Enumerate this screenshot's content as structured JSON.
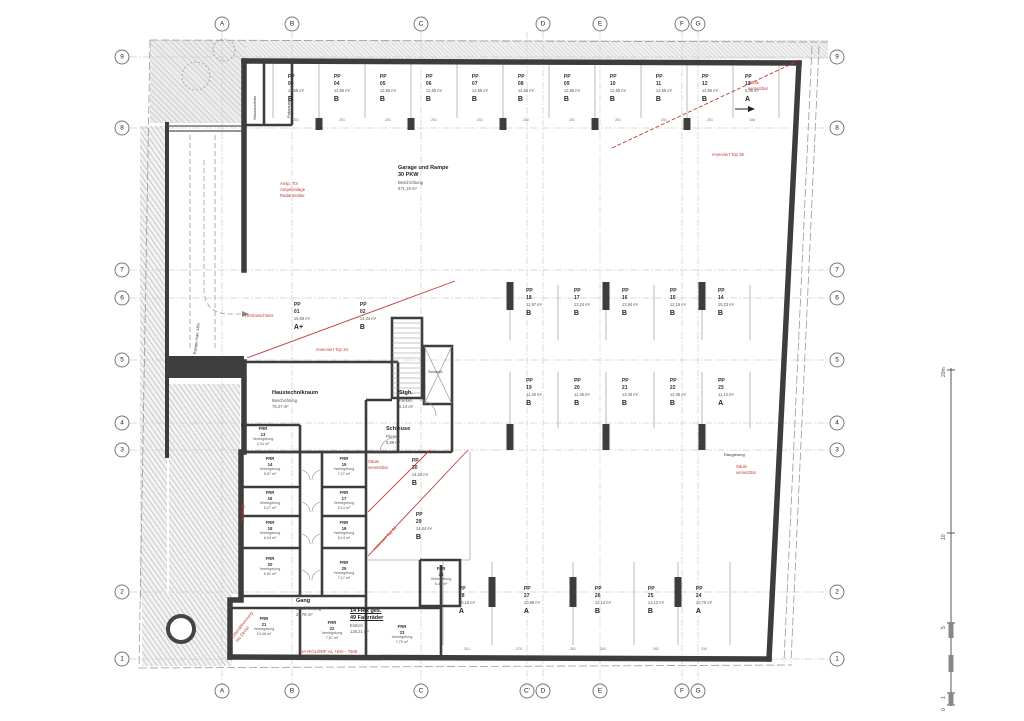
{
  "grid": {
    "bubbles": [
      {
        "label": "A",
        "x": 222,
        "y": 24
      },
      {
        "label": "B",
        "x": 292,
        "y": 24
      },
      {
        "label": "C",
        "x": 421,
        "y": 24
      },
      {
        "label": "D",
        "x": 543,
        "y": 24
      },
      {
        "label": "E",
        "x": 600,
        "y": 24
      },
      {
        "label": "F",
        "x": 682,
        "y": 24
      },
      {
        "label": "G",
        "x": 698,
        "y": 24
      },
      {
        "label": "A",
        "x": 222,
        "y": 691
      },
      {
        "label": "B",
        "x": 292,
        "y": 691
      },
      {
        "label": "C",
        "x": 421,
        "y": 691
      },
      {
        "label": "C'",
        "x": 527,
        "y": 691
      },
      {
        "label": "D",
        "x": 543,
        "y": 691
      },
      {
        "label": "E",
        "x": 600,
        "y": 691
      },
      {
        "label": "F",
        "x": 682,
        "y": 691
      },
      {
        "label": "G",
        "x": 698,
        "y": 691
      },
      {
        "label": "9",
        "x": 122,
        "y": 57
      },
      {
        "label": "8",
        "x": 122,
        "y": 128
      },
      {
        "label": "7",
        "x": 122,
        "y": 270
      },
      {
        "label": "6",
        "x": 122,
        "y": 298
      },
      {
        "label": "5",
        "x": 122,
        "y": 360
      },
      {
        "label": "4",
        "x": 122,
        "y": 423
      },
      {
        "label": "3",
        "x": 122,
        "y": 450
      },
      {
        "label": "2",
        "x": 122,
        "y": 592
      },
      {
        "label": "1",
        "x": 122,
        "y": 659
      },
      {
        "label": "9",
        "x": 837,
        "y": 57
      },
      {
        "label": "8",
        "x": 837,
        "y": 128
      },
      {
        "label": "7",
        "x": 837,
        "y": 270
      },
      {
        "label": "6",
        "x": 837,
        "y": 298
      },
      {
        "label": "5",
        "x": 837,
        "y": 360
      },
      {
        "label": "4",
        "x": 837,
        "y": 423
      },
      {
        "label": "3",
        "x": 837,
        "y": 450
      },
      {
        "label": "2",
        "x": 837,
        "y": 592
      },
      {
        "label": "1",
        "x": 837,
        "y": 659
      }
    ]
  },
  "parking": [
    {
      "id": "PP\n03",
      "area": "12,65 m²",
      "type": "B",
      "x": 296,
      "y": 74
    },
    {
      "id": "PP\n04",
      "area": "12,55 m²",
      "type": "B",
      "x": 342,
      "y": 74
    },
    {
      "id": "PP\n05",
      "area": "12,55 m²",
      "type": "B",
      "x": 388,
      "y": 74
    },
    {
      "id": "PP\n06",
      "area": "12,55 m²",
      "type": "B",
      "x": 434,
      "y": 74
    },
    {
      "id": "PP\n07",
      "area": "12,55 m²",
      "type": "B",
      "x": 480,
      "y": 74
    },
    {
      "id": "PP\n08",
      "area": "12,55 m²",
      "type": "B",
      "x": 526,
      "y": 74
    },
    {
      "id": "PP\n09",
      "area": "12,65 m²",
      "type": "B",
      "x": 572,
      "y": 74
    },
    {
      "id": "PP\n10",
      "area": "12,55 m²",
      "type": "B",
      "x": 618,
      "y": 74
    },
    {
      "id": "PP\n11",
      "area": "12,55 m²",
      "type": "B",
      "x": 664,
      "y": 74
    },
    {
      "id": "PP\n12",
      "area": "12,55 m²",
      "type": "B",
      "x": 710,
      "y": 74
    },
    {
      "id": "PP\n13",
      "area": "5,05 m²",
      "type": "A",
      "x": 752,
      "y": 74
    },
    {
      "id": "PP\n18",
      "area": "11,97 m²",
      "type": "B",
      "x": 534,
      "y": 288
    },
    {
      "id": "PP\n17",
      "area": "13,24 m²",
      "type": "B",
      "x": 582,
      "y": 288
    },
    {
      "id": "PP\n16",
      "area": "13,94 m²",
      "type": "B",
      "x": 630,
      "y": 288
    },
    {
      "id": "PP\n15",
      "area": "12,16 m²",
      "type": "B",
      "x": 678,
      "y": 288
    },
    {
      "id": "PP\n14",
      "area": "15,23 m²",
      "type": "B",
      "x": 726,
      "y": 288
    },
    {
      "id": "PP\n19",
      "area": "11,40 m²",
      "type": "B",
      "x": 534,
      "y": 378
    },
    {
      "id": "PP\n20",
      "area": "11,36 m²",
      "type": "B",
      "x": 582,
      "y": 378
    },
    {
      "id": "PP\n21",
      "area": "13,40 m²",
      "type": "B",
      "x": 630,
      "y": 378
    },
    {
      "id": "PP\n22",
      "area": "12,35 m²",
      "type": "B",
      "x": 678,
      "y": 378
    },
    {
      "id": "PP\n23",
      "area": "11,12 m²",
      "type": "A",
      "x": 726,
      "y": 378
    },
    {
      "id": "PP\n28",
      "area": "10,15 m²",
      "type": "A",
      "x": 467,
      "y": 586
    },
    {
      "id": "PP\n27",
      "area": "10,89 m²",
      "type": "A",
      "x": 532,
      "y": 586
    },
    {
      "id": "PP\n26",
      "area": "12,14 m²",
      "type": "B",
      "x": 603,
      "y": 586
    },
    {
      "id": "PP\n25",
      "area": "13,12 m²",
      "type": "B",
      "x": 656,
      "y": 586
    },
    {
      "id": "PP\n24",
      "area": "10,70 m²",
      "type": "A",
      "x": 704,
      "y": 586
    },
    {
      "id": "PP\n01",
      "area": "15,59 m²",
      "type": "A+",
      "x": 302,
      "y": 302
    },
    {
      "id": "PP\n02",
      "area": "14,04 m²",
      "type": "B",
      "x": 368,
      "y": 302
    },
    {
      "id": "PP\n30",
      "area": "14,04 m²",
      "type": "B",
      "x": 420,
      "y": 458
    },
    {
      "id": "PP\n29",
      "area": "14,04 m²",
      "type": "B",
      "x": 424,
      "y": 512
    }
  ],
  "frr_rooms": [
    {
      "id": "FRR\n13",
      "use": "Verriegelung",
      "area": "3,34 m²",
      "x": 263,
      "y": 426
    },
    {
      "id": "FRR\n14",
      "use": "Verriegelung",
      "area": "5,57 m²",
      "x": 270,
      "y": 456
    },
    {
      "id": "FRR\n16",
      "use": "Verriegelung",
      "area": "5,27 m²",
      "x": 270,
      "y": 490
    },
    {
      "id": "FRR\n18",
      "use": "Verriegelung",
      "area": "6,04 m²",
      "x": 270,
      "y": 520
    },
    {
      "id": "FRR\n20",
      "use": "Verriegelung",
      "area": "6,62 m²",
      "x": 270,
      "y": 556
    },
    {
      "id": "FRR\n15",
      "use": "Verriegelung",
      "area": "7,27 m²",
      "x": 344,
      "y": 456
    },
    {
      "id": "FRR\n17",
      "use": "Verriegelung",
      "area": "5,14 m²",
      "x": 344,
      "y": 490
    },
    {
      "id": "FRR\n19",
      "use": "Verriegelung",
      "area": "5,14 m²",
      "x": 344,
      "y": 520
    },
    {
      "id": "FRR\n25",
      "use": "Verriegelung",
      "area": "7,17 m²",
      "x": 344,
      "y": 560
    },
    {
      "id": "FRR\n21",
      "use": "Verriegelung",
      "area": "10,46 m²",
      "x": 264,
      "y": 616
    },
    {
      "id": "FRR\n22",
      "use": "Verriegelung",
      "area": "7,67 m²",
      "x": 332,
      "y": 620
    },
    {
      "id": "FRR\n23",
      "use": "Verriegelung",
      "area": "7,75 m²",
      "x": 402,
      "y": 624
    },
    {
      "id": "FRR\n24",
      "use": "Verriegelung",
      "area": "6,46 m²",
      "x": 441,
      "y": 566
    }
  ],
  "rooms": [
    {
      "name": "Garage und Rampe\n30 PKW",
      "info": "Beschichtung\n971,18 m²",
      "x": 398,
      "y": 165
    },
    {
      "name": "Haustechnikraum",
      "info": "Beschichtung\n76,27 m²",
      "x": 272,
      "y": 390
    },
    {
      "name": "Stgh.",
      "info": "Fliesen\n5,14 m²",
      "x": 399,
      "y": 390
    },
    {
      "name": "Schleuse",
      "info": "Fliesen\n6,89 m²",
      "x": 386,
      "y": 426
    },
    {
      "name": "Gang",
      "info": "Beschichtung\n28,78 m²",
      "x": 296,
      "y": 598
    },
    {
      "name": "14 FRR ges.\n49 Fahrräder",
      "info": "Estrich\n126,21 m²",
      "x": 350,
      "y": 608,
      "cls": "underline"
    }
  ],
  "red_notes": [
    {
      "text": "Säule\nversetzbar",
      "x": 748,
      "y": 80
    },
    {
      "text": "reserviert Top 35",
      "x": 712,
      "y": 152
    },
    {
      "text": "Ansp. Tor\nAmpelanlage\nRadarmelder",
      "x": 280,
      "y": 181
    },
    {
      "text": "Drehanschluss",
      "x": 245,
      "y": 313
    },
    {
      "text": "reserviert Top 34",
      "x": 316,
      "y": 347
    },
    {
      "text": "Säule\nversetzbar",
      "x": 368,
      "y": 459
    },
    {
      "text": "reserviert Top 01",
      "x": 372,
      "y": 548,
      "rot": -46
    },
    {
      "text": "Säule\nversetzbar",
      "x": 736,
      "y": 464
    },
    {
      "text": "Gitterabtrennung\nbis Decke",
      "x": 230,
      "y": 636,
      "rot": -52
    },
    {
      "text": "Dehnfuge",
      "x": 240,
      "y": 522,
      "rot": -90
    },
    {
      "text": "NA+EGL/8NF-AL +KKr - 7508",
      "x": 300,
      "y": 649
    }
  ],
  "black_notes": [
    {
      "text": "Rampe max. 18%",
      "x": 192,
      "y": 354,
      "rot": -83
    },
    {
      "text": "Wasserzähler",
      "x": 252,
      "y": 120,
      "rot": -90
    },
    {
      "text": "Putzraum",
      "x": 286,
      "y": 118,
      "rot": -90
    },
    {
      "text": "Nachbarbestand",
      "x": 558,
      "y": 60
    },
    {
      "text": "Schacht",
      "x": 428,
      "y": 369
    },
    {
      "text": "Rangierung",
      "x": 724,
      "y": 452
    }
  ],
  "dims": [
    {
      "t": "261",
      "x": 296,
      "y": 118
    },
    {
      "t": "251",
      "x": 342,
      "y": 118
    },
    {
      "t": "251",
      "x": 388,
      "y": 118
    },
    {
      "t": "251",
      "x": 434,
      "y": 118
    },
    {
      "t": "251",
      "x": 480,
      "y": 118
    },
    {
      "t": "250",
      "x": 526,
      "y": 118
    },
    {
      "t": "251",
      "x": 572,
      "y": 118
    },
    {
      "t": "251",
      "x": 618,
      "y": 118
    },
    {
      "t": "251",
      "x": 664,
      "y": 118
    },
    {
      "t": "251",
      "x": 710,
      "y": 118
    },
    {
      "t": "188",
      "x": 752,
      "y": 118
    },
    {
      "t": "301",
      "x": 467,
      "y": 647
    },
    {
      "t": "370",
      "x": 519,
      "y": 647
    },
    {
      "t": "301",
      "x": 573,
      "y": 647
    },
    {
      "t": "282",
      "x": 603,
      "y": 647
    },
    {
      "t": "282",
      "x": 656,
      "y": 647
    },
    {
      "t": "334",
      "x": 704,
      "y": 647
    },
    {
      "t": "20m",
      "x": 941,
      "y": 377,
      "rot": -90,
      "cls": "scale"
    },
    {
      "t": "10",
      "x": 941,
      "y": 540,
      "rot": -90,
      "cls": "scale"
    },
    {
      "t": "5",
      "x": 941,
      "y": 629,
      "rot": -90,
      "cls": "scale"
    },
    {
      "t": "1",
      "x": 941,
      "y": 699,
      "rot": -90,
      "cls": "scale"
    },
    {
      "t": "0",
      "x": 941,
      "y": 711,
      "rot": -90,
      "cls": "scale"
    }
  ]
}
